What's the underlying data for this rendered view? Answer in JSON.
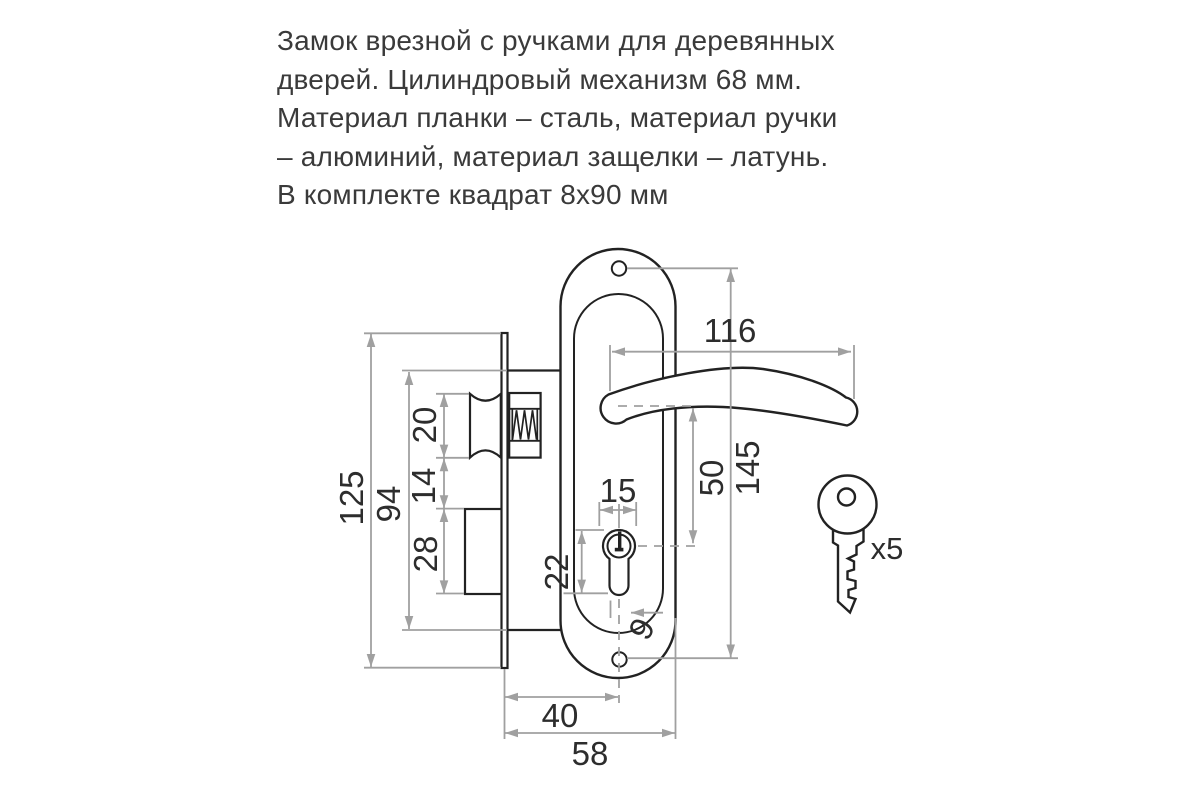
{
  "description": {
    "lines": [
      "Замок врезной с ручками для деревянных",
      "дверей. Цилиндровый механизм 68 мм.",
      "Материал планки – сталь, материал ручки",
      "– алюминий, материал защелки – латунь.",
      "В комплекте квадрат 8х90 мм"
    ]
  },
  "dimensions": {
    "overall_height": "125",
    "body_height": "94",
    "latch_height": "20",
    "latch_gap": "14",
    "deadbolt_height": "28",
    "keyhole_height": "22",
    "cylinder_width": "15",
    "handle_to_cylinder": "50",
    "hole_spacing": "145",
    "handle_length": "116",
    "keyhole_offset": "9",
    "backset": "40",
    "body_depth": "58"
  },
  "key": {
    "count_label": "x5"
  },
  "colors": {
    "outline": "#222222",
    "dimension_line": "#a0a0a0",
    "label_text": "#2d2d2d",
    "description_text": "#3a3a3a",
    "background": "#ffffff"
  }
}
